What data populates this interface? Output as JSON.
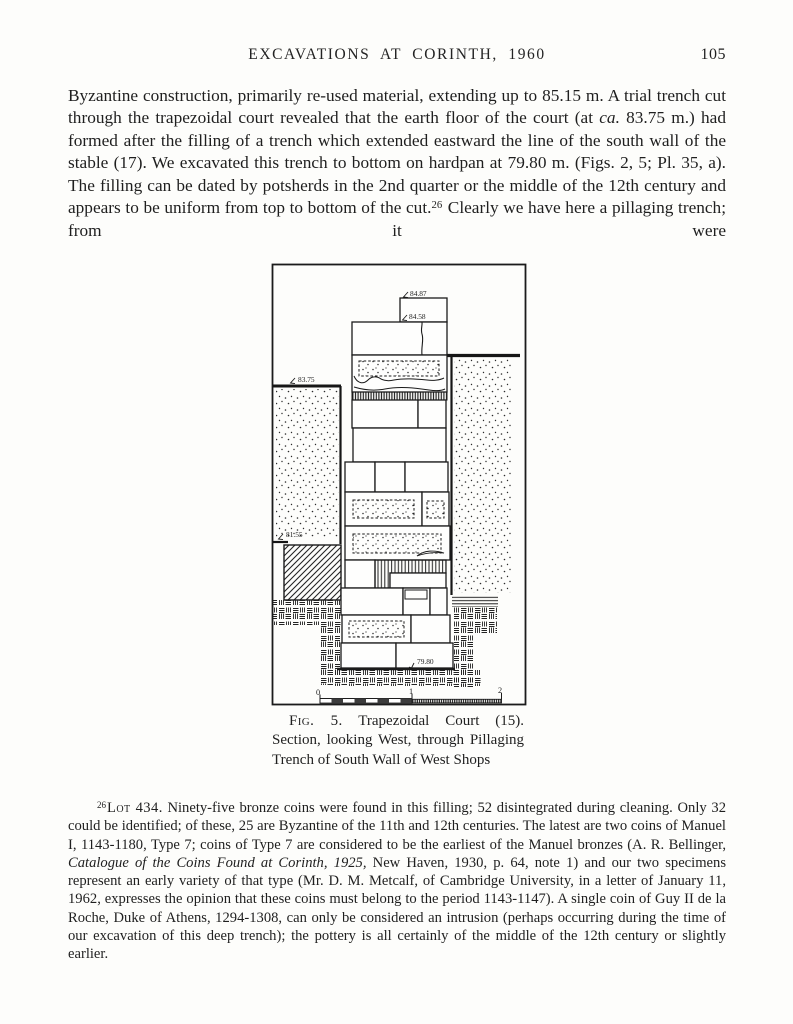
{
  "header": {
    "title": "EXCAVATIONS AT CORINTH, 1960",
    "page_number": "105"
  },
  "body": {
    "seg1": "Byzantine construction, primarily re-used material, extending up to 85.15 m. A trial trench cut through the trapezoidal court revealed that the earth floor of the court (at ",
    "seg_italic": "ca.",
    "seg2": " 83.75 m.) had formed after the filling of a trench which extended eastward the line of the south wall of the stable (17). We excavated this trench to bottom on hardpan at 79.80 m. (Figs. 2, 5; Pl. 35, a). The filling can be dated by potsherds in the 2nd quarter or the middle of the 12th century and appears to be uniform from top to bottom of the cut.",
    "footnote_ref": "26",
    "seg3": " Clearly we have here a pillaging trench; from it were"
  },
  "figure": {
    "elevations": {
      "top": "84.87",
      "upper": "84.58",
      "court_floor": "83.75",
      "left_level": "81.55",
      "hardpan": "79.80"
    },
    "scale_ticks": [
      "0",
      "1",
      "2"
    ],
    "caption_fig": "Fig. 5.",
    "caption_rest": " Trapezoidal Court (15). Section, looking West, through Pillaging Trench of South Wall of West Shops"
  },
  "footnote": {
    "ref": "26",
    "lot_label": "Lot 434.",
    "seg1": " Ninety-five bronze coins were found in this filling; 52 disintegrated during cleaning. Only 32 could be identified; of these, 25 are Byzantine of the 11th and 12th centuries. The latest are two coins of Manuel I, 1143-1180, Type 7; coins of Type 7 are considered to be the earliest of the Manuel bronzes (A. R. Bellinger, ",
    "seg_italic": "Catalogue of the Coins Found at Corinth, 1925,",
    "seg2": " New Haven, 1930, p. 64, note 1) and our two specimens represent an early variety of that type (Mr. D. M. Metcalf, of Cambridge University, in a letter of January 11, 1962, expresses the opinion that these coins must belong to the period 1143-1147). A single coin of Guy II de la Roche, Duke of Athens, 1294-1308, can only be considered an intrusion (perhaps occurring during the time of our excavation of this deep trench); the pottery is all certainly of the middle of the 12th century or slightly earlier."
  }
}
